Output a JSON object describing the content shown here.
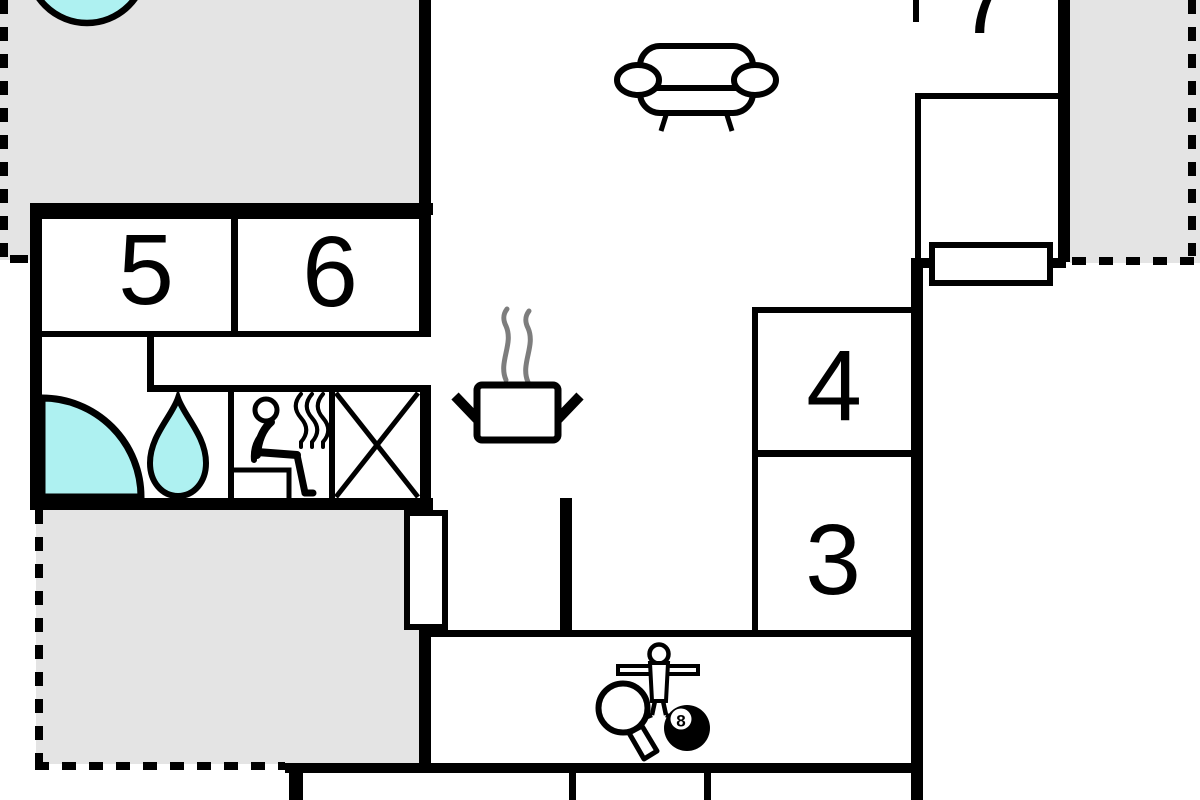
{
  "title": "apartment-floor-plan",
  "rooms": [
    {
      "id": "room-3",
      "label": "3"
    },
    {
      "id": "room-4",
      "label": "4"
    },
    {
      "id": "room-5",
      "label": "5"
    },
    {
      "id": "room-6",
      "label": "6"
    },
    {
      "id": "room-7",
      "label": "7"
    }
  ],
  "billiards": {
    "ball_label": "8"
  },
  "areas": {
    "terraces": [
      "terrace-top-left",
      "terrace-top-right",
      "terrace-bottom-left"
    ],
    "interior": [
      "living-kitchen-area",
      "hallway",
      "bathroom-sauna-area",
      "entry-corridor",
      "game-room"
    ]
  },
  "icons": [
    "hot-tub",
    "sofa",
    "cooking-pot",
    "steam",
    "shower-quarter-circle",
    "water-drop",
    "sauna-person",
    "heat-waves",
    "crossed-box",
    "window-symbol",
    "door-symbol",
    "foosball-player",
    "table-tennis-paddle",
    "billiard-8-ball"
  ],
  "colors": {
    "walls": "#000000",
    "terrace_fill": "#e4e4e4",
    "water_fill": "#aef1f1",
    "steam": "#7d7d7d",
    "background": "#ffffff"
  }
}
